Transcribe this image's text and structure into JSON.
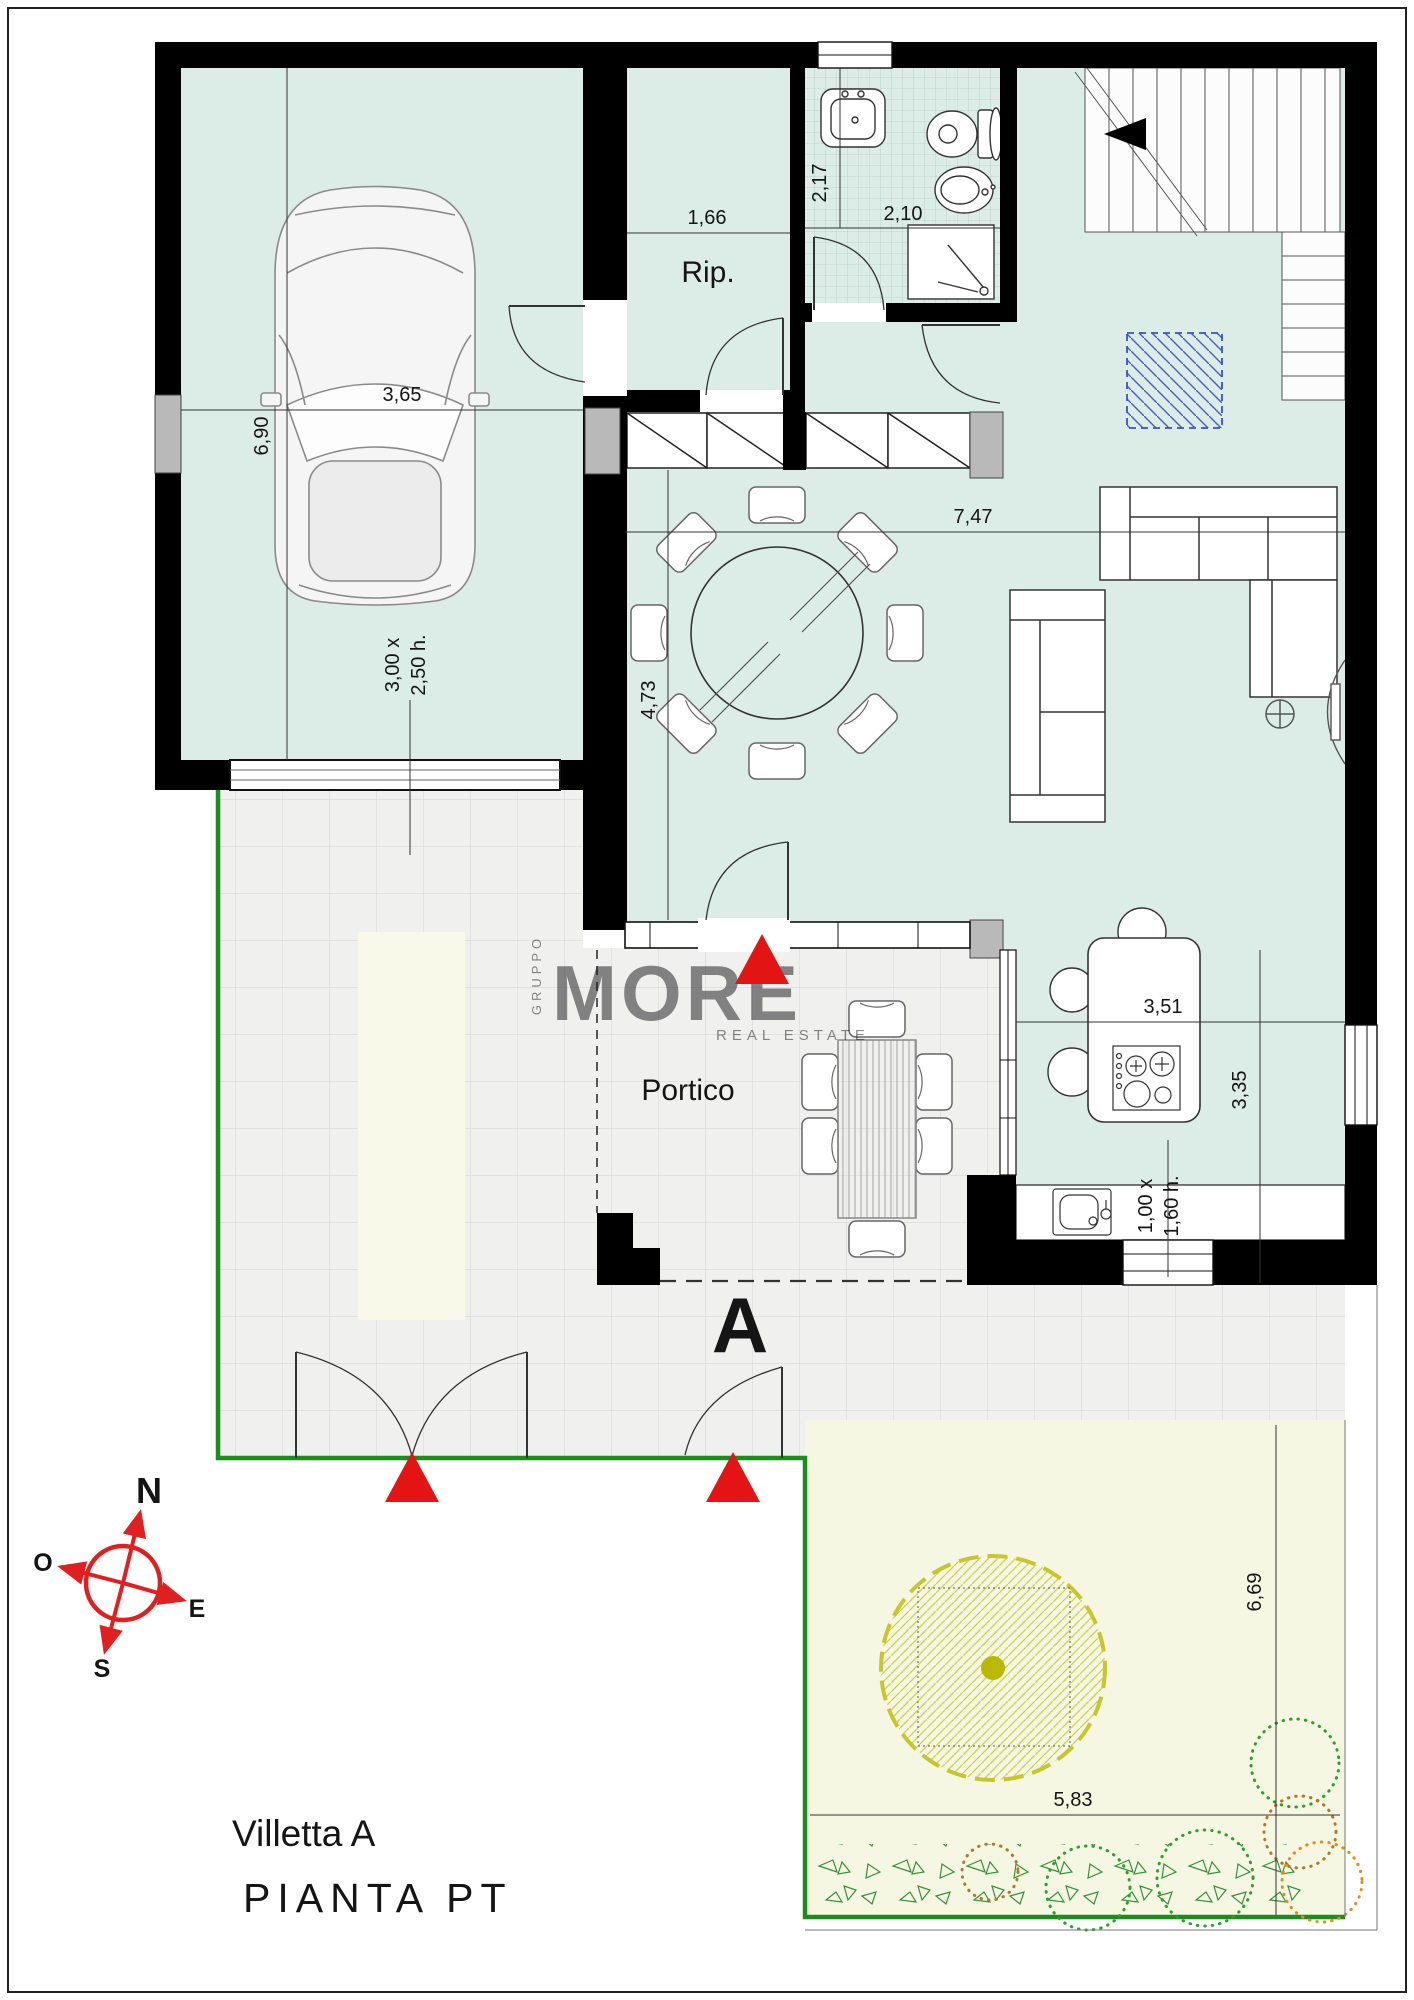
{
  "title_block": {
    "villa_name": "Villetta A",
    "plan_name": "PIANTA PT"
  },
  "section": {
    "letter": "A"
  },
  "room_labels": {
    "storage": "Rip.",
    "portico": "Portico"
  },
  "dimensions": {
    "garage": {
      "width": "3,65",
      "depth": "6,90"
    },
    "garage_door": {
      "line1": "3,00 x",
      "line2": "2,50 h."
    },
    "storage": {
      "width": "1,66"
    },
    "bathroom": {
      "depth": "2,17",
      "width": "2,10"
    },
    "living": {
      "width": "7,47",
      "depth": "4,73"
    },
    "kitchen": {
      "width": "3,51",
      "depth": "3,35"
    },
    "kitchen_window": {
      "line1": "1,00 x",
      "line2": "1,60 h."
    },
    "garden": {
      "width": "5,83",
      "depth": "6,69"
    }
  },
  "compass": {
    "n": "N",
    "e": "E",
    "s": "S",
    "o": "O"
  },
  "watermark": {
    "top": "GRUPPO",
    "main": "MORE",
    "bottom": "REAL ESTATE"
  },
  "colors": {
    "wall": "#000000",
    "floor": "#dcece6",
    "paving": "#f0f0ef",
    "garden": "#f6f7e2",
    "flowerbed": "#f8f9e8",
    "boundary_green": "#1c8c1c",
    "accent_blue": "#1520cc",
    "compass_blue": "#1414c8",
    "accent_red": "#e51414",
    "tree_olive": "#c6c62e"
  }
}
